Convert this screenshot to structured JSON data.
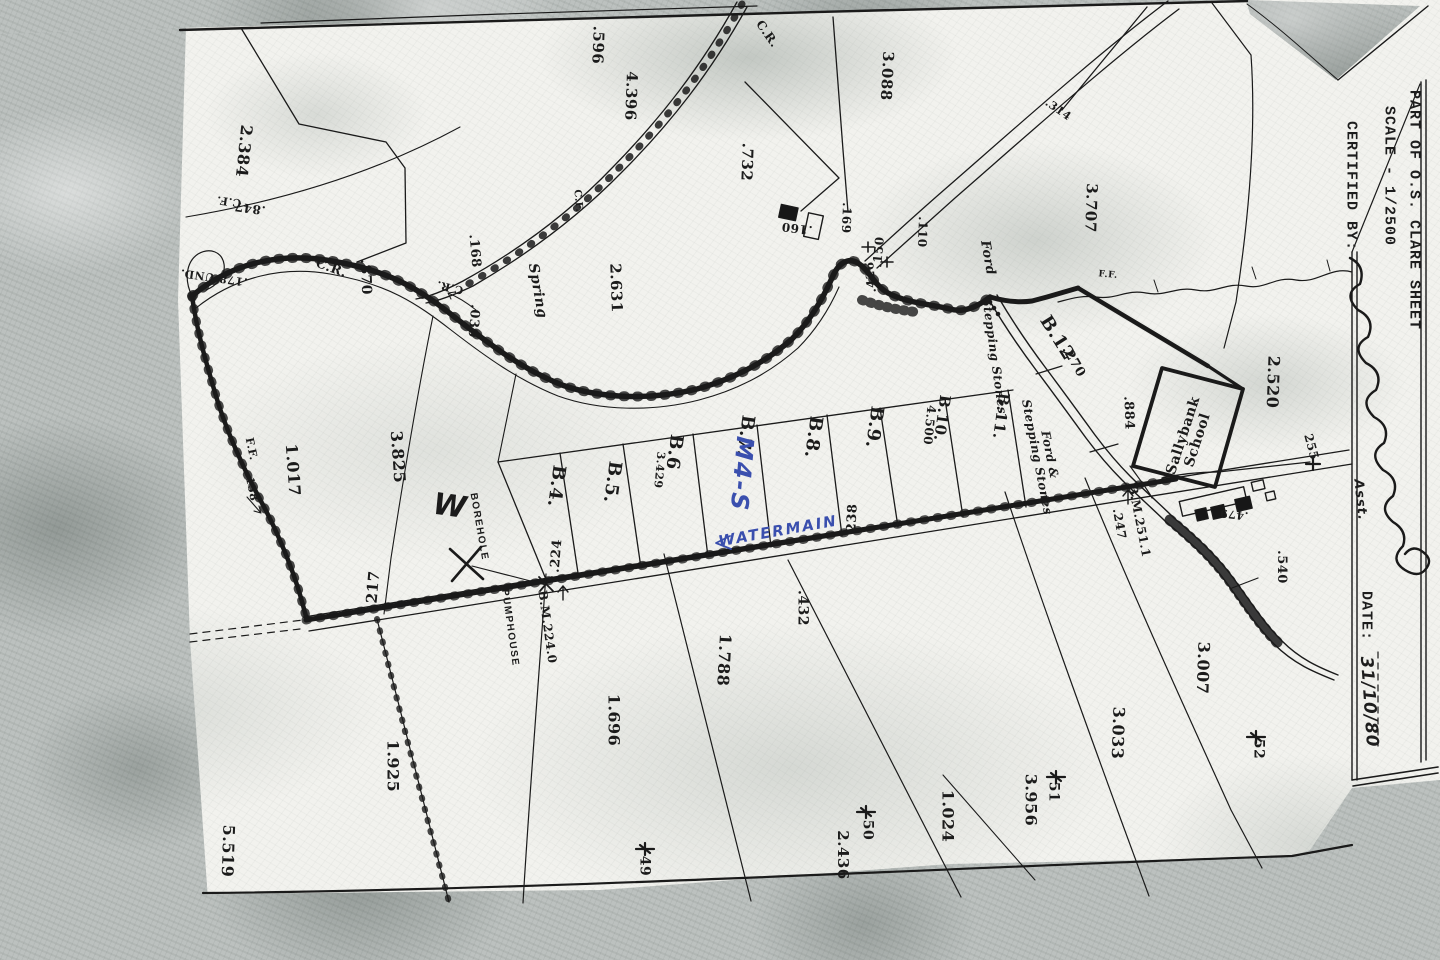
{
  "sheet": {
    "margin": {
      "part_of": "PART OF O.S. CLARE SHEET",
      "scale": "SCALE - 1/2500",
      "certified_label": "CERTIFIED BY:",
      "assistant_note": "Asst.",
      "date_label": "DATE:",
      "date_value": "31/10/80"
    }
  },
  "colors": {
    "ink": "#1b1b1b",
    "blue_pen": "#3a4fae",
    "paper": "#f2f2ee",
    "scanner_grey": "#bcc1bf"
  },
  "map_labels": [
    {
      "t": ".596",
      "x": 598,
      "y": 45,
      "r": 92,
      "s": 15
    },
    {
      "t": "2.384",
      "x": 244,
      "y": 151,
      "r": 96,
      "s": 16
    },
    {
      "t": "4.396",
      "x": 631,
      "y": 96,
      "r": 92,
      "s": 15
    },
    {
      "t": "3.088",
      "x": 887,
      "y": 76,
      "r": 93,
      "s": 15
    },
    {
      "t": ".732",
      "x": 747,
      "y": 162,
      "r": 92,
      "s": 15
    },
    {
      "t": "3.707",
      "x": 1091,
      "y": 208,
      "r": 92,
      "s": 15
    },
    {
      "t": ".314",
      "x": 1058,
      "y": 110,
      "r": 35,
      "s": 11
    },
    {
      "t": ".847",
      "x": 250,
      "y": 208,
      "r": 188,
      "s": 12
    },
    {
      "t": "C.F.",
      "x": 229,
      "y": 201,
      "r": 188,
      "s": 11
    },
    {
      "t": "C.R.",
      "x": 767,
      "y": 34,
      "r": 55,
      "s": 12
    },
    {
      "t": "C.R.",
      "x": 331,
      "y": 269,
      "r": 20,
      "s": 13
    },
    {
      "t": "C.R.",
      "x": 450,
      "y": 287,
      "r": 193,
      "s": 11
    },
    {
      "t": ".870",
      "x": 365,
      "y": 277,
      "r": 88,
      "s": 14
    },
    {
      "t": ".168",
      "x": 474,
      "y": 251,
      "r": 85,
      "s": 13
    },
    {
      "t": ".030",
      "x": 473,
      "y": 321,
      "r": 95,
      "s": 13
    },
    {
      "t": "Spring",
      "x": 537,
      "y": 291,
      "r": 80,
      "s": 14,
      "c": "it"
    },
    {
      "t": "2.631",
      "x": 616,
      "y": 288,
      "r": 88,
      "s": 15
    },
    {
      "t": ".160",
      "x": 797,
      "y": 228,
      "r": 187,
      "s": 12
    },
    {
      "t": ".169",
      "x": 846,
      "y": 218,
      "r": 92,
      "s": 12
    },
    {
      "t": ".150",
      "x": 879,
      "y": 252,
      "r": -85,
      "s": 12
    },
    {
      "t": ".110",
      "x": 922,
      "y": 232,
      "r": 92,
      "s": 12
    },
    {
      "t": ".426",
      "x": 871,
      "y": 277,
      "r": -95,
      "s": 12
    },
    {
      "t": ".178 UND.",
      "x": 214,
      "y": 277,
      "r": 188,
      "s": 11
    },
    {
      "t": "F.F.",
      "x": 251,
      "y": 449,
      "r": 78,
      "s": 11
    },
    {
      "t": ".158",
      "x": 251,
      "y": 487,
      "r": 78,
      "s": 11
    },
    {
      "t": "1.017",
      "x": 293,
      "y": 470,
      "r": 86,
      "s": 16
    },
    {
      "t": "3.825",
      "x": 398,
      "y": 457,
      "r": 86,
      "s": 16
    },
    {
      "t": "W",
      "x": 450,
      "y": 507,
      "r": 8,
      "s": 30,
      "c": "hand"
    },
    {
      "t": "BOREHOLE",
      "x": 478,
      "y": 527,
      "r": 80,
      "s": 10,
      "c": "sans"
    },
    {
      "t": "PUMPHOUSE",
      "x": 509,
      "y": 628,
      "r": 82,
      "s": 10,
      "c": "sans"
    },
    {
      "t": "B.M.224.0",
      "x": 547,
      "y": 627,
      "r": 82,
      "s": 12
    },
    {
      "t": ".224",
      "x": 557,
      "y": 556,
      "r": -85,
      "s": 13
    },
    {
      "t": "217",
      "x": 373,
      "y": 587,
      "r": -85,
      "s": 15
    },
    {
      "t": "1.925",
      "x": 393,
      "y": 766,
      "r": 90,
      "s": 16
    },
    {
      "t": "5.519",
      "x": 228,
      "y": 851,
      "r": 92,
      "s": 16
    },
    {
      "t": "1.696",
      "x": 614,
      "y": 720,
      "r": 90,
      "s": 16
    },
    {
      "t": "1.788",
      "x": 724,
      "y": 660,
      "r": 93,
      "s": 16
    },
    {
      "t": ".432",
      "x": 802,
      "y": 608,
      "r": 90,
      "s": 14
    },
    {
      "t": "2.436",
      "x": 843,
      "y": 855,
      "r": 90,
      "s": 15
    },
    {
      "t": "50",
      "x": 867,
      "y": 830,
      "r": 90,
      "s": 14
    },
    {
      "t": "49",
      "x": 644,
      "y": 866,
      "r": 90,
      "s": 14
    },
    {
      "t": "51",
      "x": 1053,
      "y": 792,
      "r": 90,
      "s": 14
    },
    {
      "t": "52",
      "x": 1258,
      "y": 749,
      "r": 90,
      "s": 14
    },
    {
      "t": "1.024",
      "x": 948,
      "y": 816,
      "r": 90,
      "s": 16
    },
    {
      "t": "3.956",
      "x": 1031,
      "y": 800,
      "r": 90,
      "s": 16
    },
    {
      "t": "3.033",
      "x": 1118,
      "y": 733,
      "r": 92,
      "s": 16
    },
    {
      "t": "3.007",
      "x": 1203,
      "y": 668,
      "r": 92,
      "s": 16
    },
    {
      "t": ".540",
      "x": 1281,
      "y": 567,
      "r": 90,
      "s": 13
    },
    {
      "t": "2.520",
      "x": 1273,
      "y": 382,
      "r": 92,
      "s": 16
    },
    {
      "t": "255",
      "x": 1311,
      "y": 447,
      "r": 75,
      "s": 12
    },
    {
      "t": ".479",
      "x": 1234,
      "y": 514,
      "r": 186,
      "s": 11
    },
    {
      "t": ".884",
      "x": 1128,
      "y": 413,
      "r": 88,
      "s": 13
    },
    {
      "t": ".270",
      "x": 1073,
      "y": 362,
      "r": 60,
      "s": 13
    },
    {
      "t": "B.12",
      "x": 1057,
      "y": 338,
      "r": 58,
      "s": 18
    },
    {
      "t": "B.4.",
      "x": 556,
      "y": 486,
      "r": 98,
      "s": 18
    },
    {
      "t": "B.5.",
      "x": 612,
      "y": 482,
      "r": 98,
      "s": 18
    },
    {
      "t": "3.429",
      "x": 659,
      "y": 470,
      "r": 95,
      "s": 11
    },
    {
      "t": "B.6",
      "x": 674,
      "y": 452,
      "r": 98,
      "s": 18
    },
    {
      "t": "B.7.",
      "x": 745,
      "y": 436,
      "r": 98,
      "s": 18
    },
    {
      "t": "M4-S",
      "x": 741,
      "y": 474,
      "r": 95,
      "s": 24,
      "c": "handblue"
    },
    {
      "t": "B.8.",
      "x": 813,
      "y": 437,
      "r": 98,
      "s": 18
    },
    {
      "t": "B.9.",
      "x": 874,
      "y": 427,
      "r": 98,
      "s": 18
    },
    {
      "t": "4.500",
      "x": 929,
      "y": 425,
      "r": 96,
      "s": 12
    },
    {
      "t": "B.10.",
      "x": 942,
      "y": 418,
      "r": 98,
      "s": 15
    },
    {
      "t": "B.11.",
      "x": 1001,
      "y": 416,
      "r": 98,
      "s": 15
    },
    {
      "t": "Ford",
      "x": 987,
      "y": 258,
      "r": 80,
      "s": 13,
      "c": "it"
    },
    {
      "t": "Stepping Stones",
      "x": 994,
      "y": 356,
      "r": 82,
      "s": 12,
      "c": "it"
    },
    {
      "t": "Ford &\nStepping Stones",
      "x": 1043,
      "y": 456,
      "r": 79,
      "s": 12,
      "c": "it"
    },
    {
      "t": "Sallybank\nSchool",
      "x": 1191,
      "y": 438,
      "r": -72,
      "s": 14
    },
    {
      "t": "B.M.251.1",
      "x": 1139,
      "y": 521,
      "r": 79,
      "s": 12
    },
    {
      "t": ".247",
      "x": 1119,
      "y": 524,
      "r": 80,
      "s": 12
    },
    {
      "t": "238",
      "x": 853,
      "y": 518,
      "r": -87,
      "s": 13
    },
    {
      "t": "WATERMAIN",
      "x": 778,
      "y": 531,
      "r": -10,
      "s": 15,
      "c": "handblue"
    },
    {
      "t": "F.F.",
      "x": 1108,
      "y": 276,
      "r": 5,
      "s": 9
    },
    {
      "t": "C.F.",
      "x": 577,
      "y": 201,
      "r": 85,
      "s": 10
    }
  ]
}
